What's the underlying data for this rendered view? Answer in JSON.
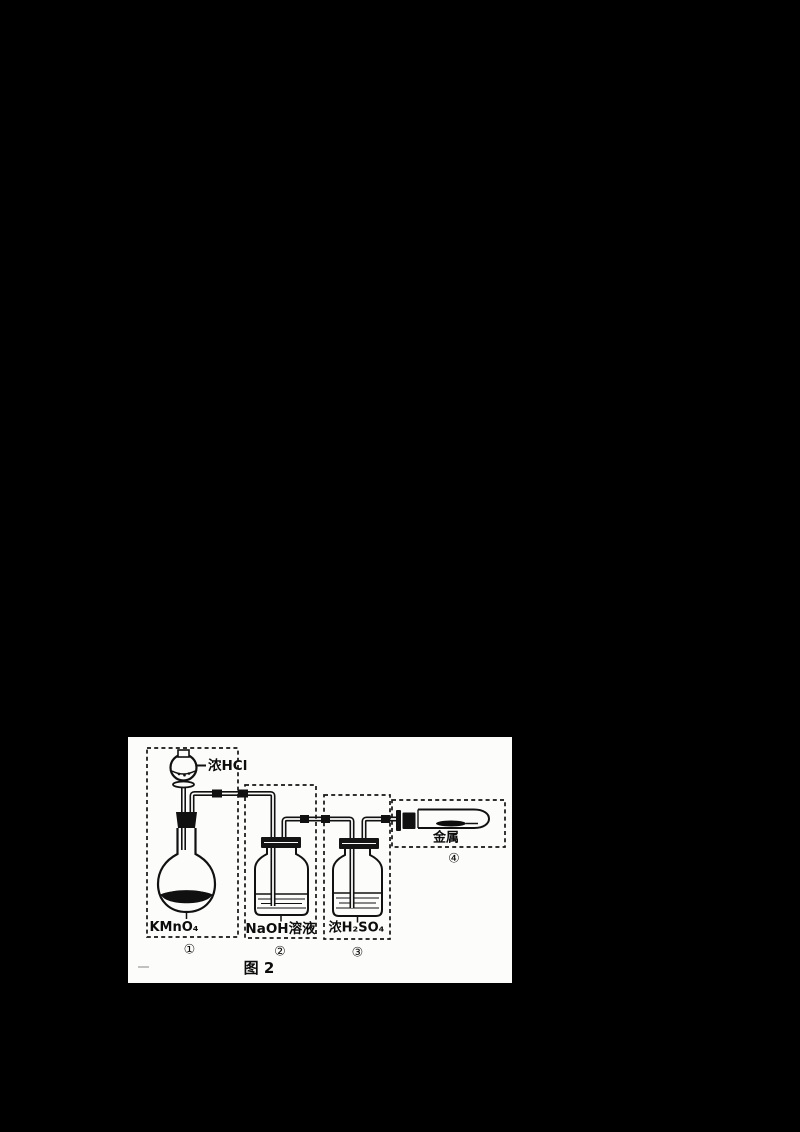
{
  "figure": {
    "caption": "图 2",
    "funnel_reagent": "浓HCl",
    "units": [
      {
        "number": "①",
        "label": "KMnO₄",
        "apparatus": "round-bottom-flask-with-dropping-funnel"
      },
      {
        "number": "②",
        "label": "NaOH溶液",
        "apparatus": "gas-washing-bottle"
      },
      {
        "number": "③",
        "label": "浓H₂SO₄",
        "apparatus": "gas-washing-bottle"
      },
      {
        "number": "④",
        "label": "金属",
        "apparatus": "horizontal-test-tube"
      }
    ],
    "colors": {
      "page_bg": "#000000",
      "panel_bg": "#fcfcfa",
      "ink": "#111111"
    }
  }
}
